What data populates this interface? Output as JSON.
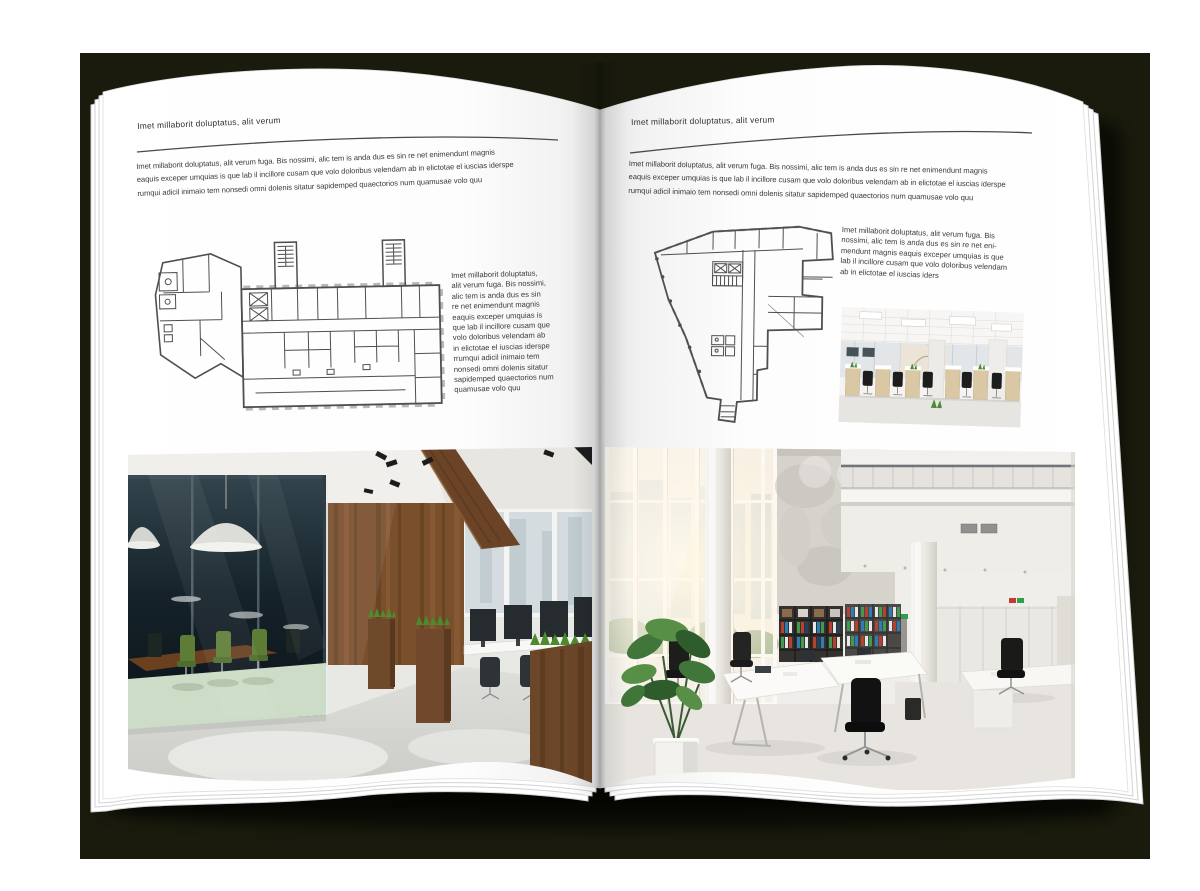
{
  "artwork": {
    "background_color": "#ffffff",
    "backdrop_color": "#1a1b0d",
    "description": "Open magazine spread mockup with floor plans and office interior photos"
  },
  "left_page": {
    "header": "Imet millaborit doluptatus, alit verum",
    "intro_lines": [
      "Imet millaborit doluptatus, alit verum fuga. Bis nossimi, alic tem is anda dus es sin re net enimendunt magnis",
      "eaquis exceper umquias is que lab il incillore cusam que volo doloribus velendam ab in elictotae el iuscias iderspe",
      "rumqui adicil inimaio tem nonsedi omni dolenis sitatur sapidemped quaectorios num quamusae volo quu"
    ],
    "side_text_lines": [
      "Imet millaborit doluptatus,",
      "alit verum fuga. Bis nossimi,",
      "alic tem is anda dus es sin",
      "re net enimendunt magnis",
      "eaquis exceper umquias is",
      "que lab il incillore cusam que",
      "volo doloribus velendam ab",
      "in elictotae el iuscias iderspe",
      "rrumqui adicil inimaio tem",
      "nonsedi omni dolenis sitatur",
      "sapidemped quaectorios num",
      "quamusae volo quu"
    ],
    "floorplan": "rectangular-office-building-floor-plan",
    "photo": "dark-loft-office-interior-photo"
  },
  "right_page": {
    "header": "Imet millaborit doluptatus, alit verum",
    "intro_lines": [
      "Imet millaborit doluptatus, alit verum fuga. Bis nossimi, alic tem is anda dus es sin re net enimendunt magnis",
      "eaquis exceper umquias is que lab il incillore cusam que volo doloribus velendam ab in elictotae el iuscias iderspe",
      "rumqui adicil inimaio tem nonsedi omni dolenis sitatur sapidemped quaectorios num quamusae volo quu"
    ],
    "side_text_lines": [
      "Imet millaborit doluptatus, alit verum fuga. Bis",
      "nossimi, alic tem is anda dus es sin re net eni-",
      "mendunt magnis eaquis exceper umquias is que",
      "lab il incillore cusam que volo doloribus velendam",
      "ab in elictotae el iuscias iders"
    ],
    "floorplan": "irregular-wedge-building-floor-plan",
    "photo_small": "white-open-space-office-photo",
    "photo": "bright-double-height-office-interior-photo"
  }
}
